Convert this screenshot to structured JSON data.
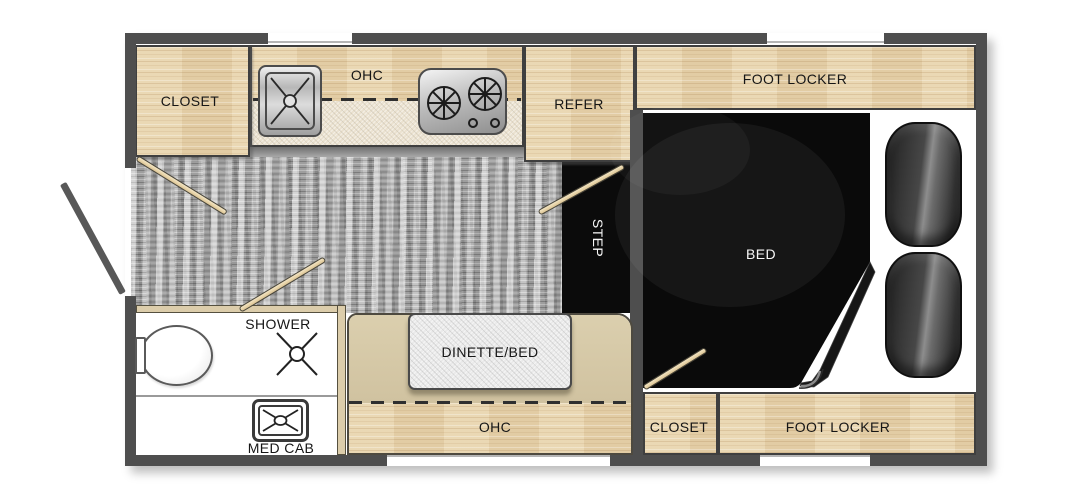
{
  "labels": {
    "closet_front": "CLOSET",
    "ohc_front": "OHC",
    "refer": "REFER",
    "foot_locker_front": "FOOT LOCKER",
    "bed": "BED",
    "step": "STEP",
    "shower": "SHOWER",
    "med_cab": "MED CAB",
    "dinette_bed": "DINETTE/BED",
    "ohc_rear": "OHC",
    "closet_rear": "CLOSET",
    "foot_locker_rear": "FOOT LOCKER"
  },
  "colors": {
    "wall": "#4e4e4e",
    "wood_cabinet": "#e9d5ae",
    "counter": "#ebe2d0",
    "dinette_bench": "#d3c5a2",
    "floor": "#b0b0b0",
    "mattress": "#0a0a0a",
    "pillow": "#3e3e3e",
    "strut": "#ead7b0",
    "table": "#ebebeb",
    "background": "#ffffff"
  },
  "icons": [
    "sink-icon",
    "stove-icon",
    "toilet-icon",
    "shower-drain-icon",
    "med-cab-icon",
    "door-swing-icon",
    "grab-handle-icon",
    "pillow-icon",
    "window-opening"
  ]
}
